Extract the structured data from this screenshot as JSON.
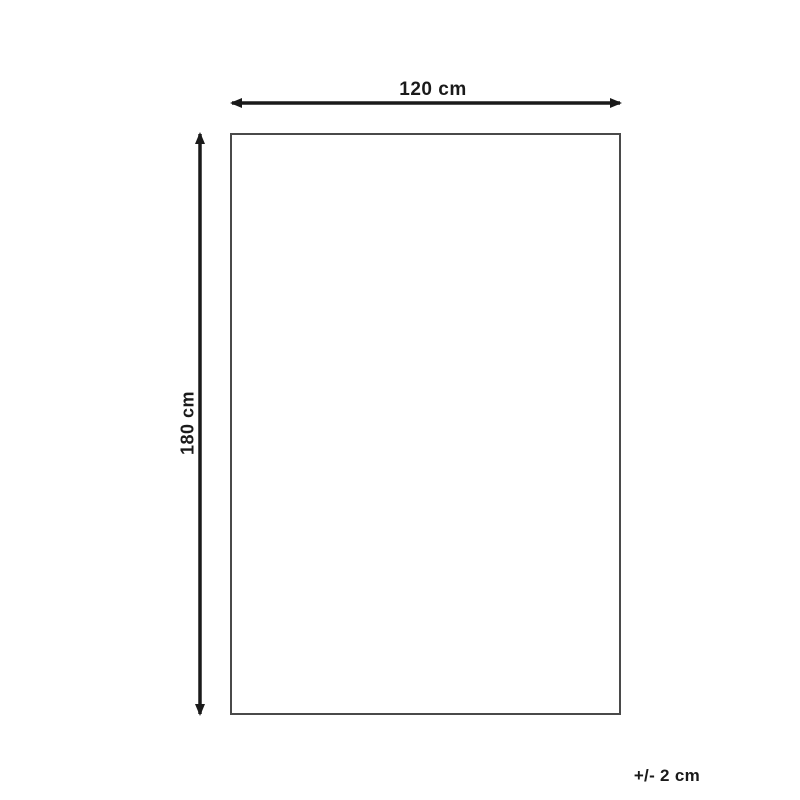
{
  "diagram": {
    "type": "product-dimension-diagram",
    "shape": "rectangle",
    "width_label": "120 cm",
    "height_label": "180 cm",
    "tolerance_label": "+/- 2 cm",
    "width_value_cm": 120,
    "height_value_cm": 180,
    "tolerance_cm": 2
  },
  "colors": {
    "background": "#ffffff",
    "arrow": "#1a1a1a",
    "text": "#1a1a1a",
    "outline": "#4a4a4a"
  }
}
